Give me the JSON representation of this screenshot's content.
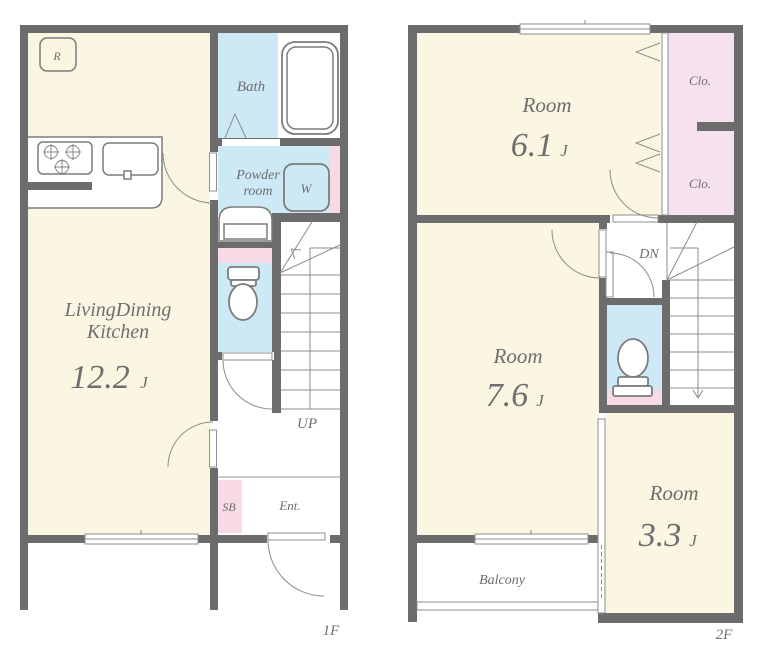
{
  "colors": {
    "wall": "#6c6c6c",
    "room_cream": "#FAF6E2",
    "wet_blue": "#CDE9F6",
    "closet_pink": "#F6E2EE",
    "accent_pink": "#F8D9E6",
    "label_gray": "#6e6e6e"
  },
  "floor1": {
    "floor_label": "1F",
    "ldk": {
      "line1": "LivingDining",
      "line2": "Kitchen",
      "size": "12.2",
      "unit": "J"
    },
    "bath": "Bath",
    "powder_line1": "Powder",
    "powder_line2": "room",
    "washer": "W",
    "fridge": "R",
    "shoebox": "SB",
    "entrance": "Ent.",
    "stairs_up": "UP"
  },
  "floor2": {
    "floor_label": "2F",
    "room_61": {
      "name": "Room",
      "size": "6.1",
      "unit": "J"
    },
    "room_76": {
      "name": "Room",
      "size": "7.6",
      "unit": "J"
    },
    "room_33": {
      "name": "Room",
      "size": "3.3",
      "unit": "J"
    },
    "closet_upper": "Clo.",
    "closet_lower": "Clo.",
    "stairs_down": "DN",
    "balcony": "Balcony"
  }
}
